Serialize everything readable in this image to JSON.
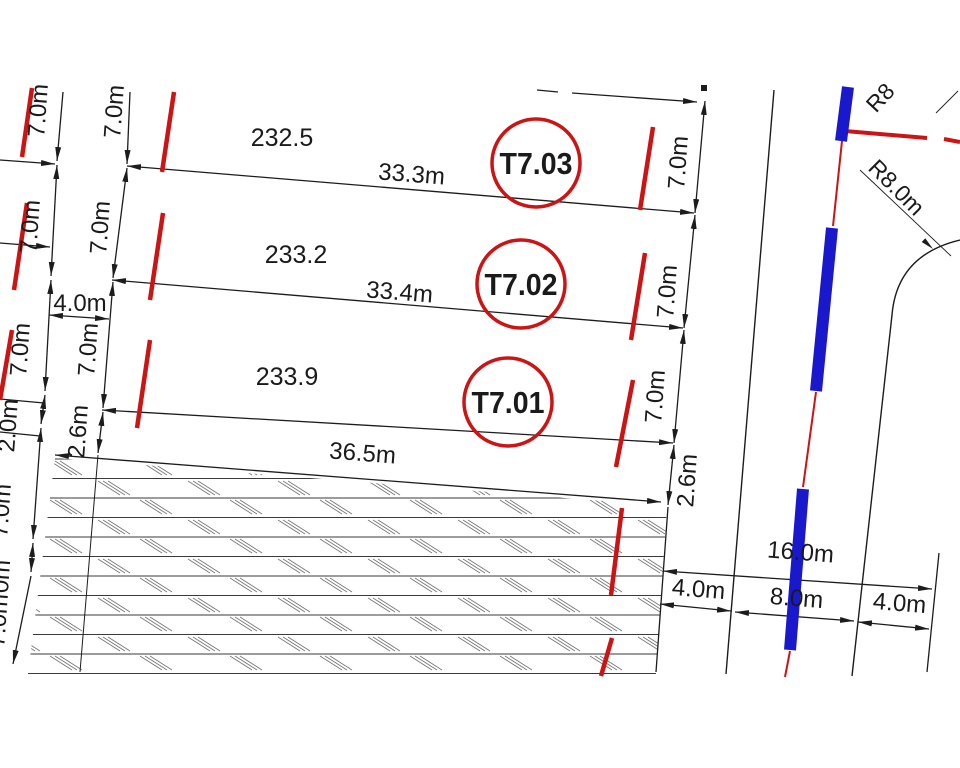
{
  "drawing": {
    "title_hint": "land subdivision site plan",
    "lot_badges": {
      "t7_03": "T7.03",
      "t7_02": "T7.02",
      "t7_01": "T7.01"
    },
    "area_values": {
      "t7_03": "232.5",
      "t7_02": "233.2",
      "t7_01": "233.9"
    },
    "width_dims": {
      "t7_03": "33.3m",
      "t7_02": "33.4m",
      "t7_01": "36.5m"
    },
    "dims": {
      "seven": "7.0m",
      "four": "4.0m",
      "two": "2.0m",
      "two_six": "2.6m",
      "clipped_zero": "0m",
      "sixteen": "16.0m",
      "eight": "8.0m"
    },
    "radius": {
      "corner": "R8.0m",
      "top_fragment": "R8"
    },
    "colors": {
      "boundary_red": "#cc1414",
      "road_center_blue": "#1a18cc",
      "line_black": "#1c1c1c"
    }
  }
}
